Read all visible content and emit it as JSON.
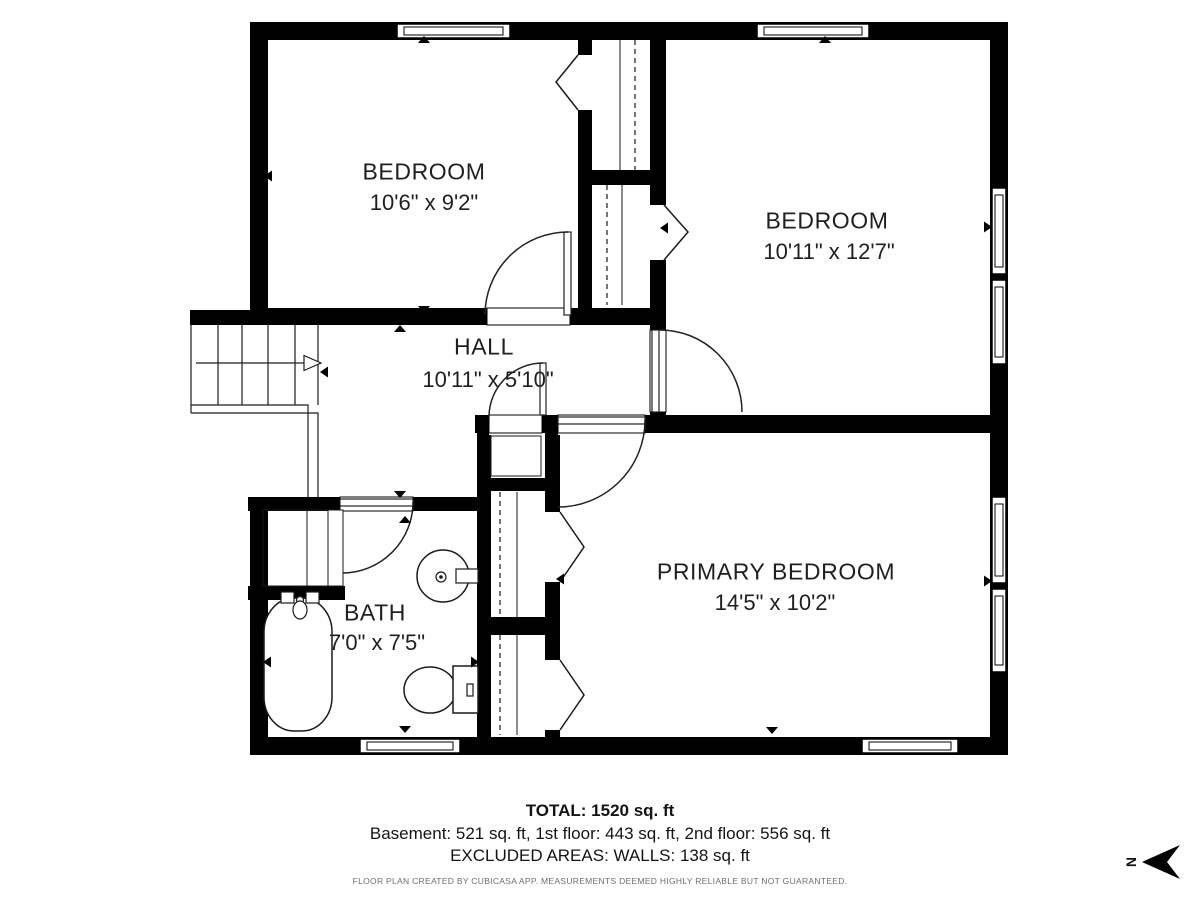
{
  "rooms": [
    {
      "name": "BEDROOM",
      "dimensions": "10'6\" x 9'2\""
    },
    {
      "name": "BEDROOM",
      "dimensions": "10'11\" x 12'7\""
    },
    {
      "name": "HALL",
      "dimensions": "10'11\" x 5'10\""
    },
    {
      "name": "BATH",
      "dimensions": "7'0\" x 7'5\""
    },
    {
      "name": "PRIMARY BEDROOM",
      "dimensions": "14'5\" x 10'2\""
    }
  ],
  "summary": {
    "total": "TOTAL: 1520 sq. ft",
    "floors": "Basement: 521 sq. ft, 1st floor: 443 sq. ft, 2nd floor: 556 sq. ft",
    "excluded": "EXCLUDED AREAS: WALLS: 138 sq. ft"
  },
  "disclaimer": "FLOOR PLAN CREATED BY CUBICASA APP. MEASUREMENTS DEEMED HIGHLY RELIABLE BUT NOT GUARANTEED.",
  "compass": {
    "label": "N"
  },
  "colors": {
    "wall": "#000000",
    "text": "#1f1f1f",
    "disclaimer": "#6e6e6e",
    "background": "#ffffff"
  }
}
